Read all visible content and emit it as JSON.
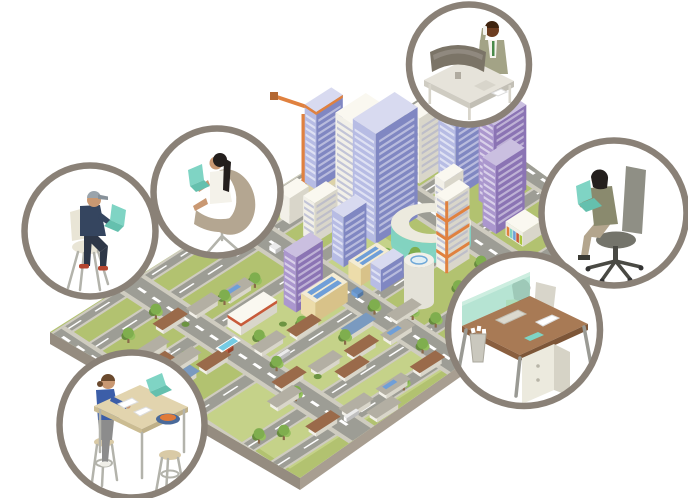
{
  "scene": {
    "description": "Isometric illustration of a city surrounded by six circular vignettes of people working remotely on laptops and at desks",
    "background": "#ffffff"
  },
  "palette": {
    "ring": "#8a8177",
    "slab_top": "#c9c4b8",
    "slab_side": "#958c80",
    "slab_side2": "#a89e91",
    "grass": "#b2c270",
    "grass_light": "#c5d289",
    "road": "#9d9d95",
    "sidewalk": "#cfccc0",
    "tan_ground": "#dcd2a8",
    "pool": "#74cbe4",
    "solar": "#6f9fd8",
    "orange": "#e0813f",
    "red_trim": "#c85a3a",
    "tree1": "#7fae4e",
    "tree3": "#95c05e",
    "trunk": "#8a6a4a",
    "teal": "#7fd4c4",
    "teal_dark": "#65c0ae",
    "metal": "#b3b3ab",
    "skin": "#c99872",
    "skin_dark": "#a06a42",
    "skin_deep": "#6e3d20",
    "hair_black": "#241f1d",
    "hair_brown": "#6b4a2e",
    "hair_dark2": "#3a2420",
    "shirt": "#f6f4ee",
    "tie": "#4a8a4a",
    "olive": "#a3a386",
    "olive_dark": "#8a8a6e",
    "navy": "#35455f",
    "pants_dark": "#2e3748",
    "cap": "#9aa4ac",
    "red_shoe": "#b5452f",
    "blue_top": "#3c5ea8",
    "grey_pants": "#8c8c8c",
    "lime": "#a9c63c",
    "chair_cream": "#e9e5d6",
    "chair_taupe": "#b4a691",
    "chair_grey": "#8f8f85",
    "chair_grey_dark": "#74746b",
    "desk_grey": "#e6e3da",
    "desk_grey_side": "#c6c3b9",
    "monitor": "#7b7467",
    "desk_brown": "#a87a55",
    "desk_brown_dark": "#8a5f3f",
    "glass": "#ace0cd",
    "bin": "#cac8be",
    "bowl": "#4a6a9a",
    "fruit": "#e07b39",
    "paper": "#ffffff",
    "stool": "#d9caa6",
    "table_top": "#e2d4ae",
    "dress": "#f4f2ea"
  },
  "city": {
    "name": "isometric-city",
    "landmarks": [
      "construction-crane",
      "downtown-towers",
      "apartment-towers",
      "solar-roof-offices",
      "helipad-tower",
      "arc-building",
      "shopping-strip",
      "suburban-houses",
      "city-park",
      "street-lamp",
      "house-pool"
    ],
    "colorways": {
      "white": {
        "l": "#f2f0e8",
        "r": "#d9d6ca",
        "t": "#faf8f0",
        "w": "#9aa0c8"
      },
      "blue": {
        "l": "#b7bce4",
        "r": "#8087c2",
        "t": "#d8daf0",
        "w": "#ffffff"
      },
      "purple": {
        "l": "#ab97ce",
        "r": "#8b74b4",
        "t": "#cabfe0",
        "w": "#ffffff"
      },
      "tan": {
        "l": "#ecdcaa",
        "r": "#d8c289",
        "t": "#f4ecd4",
        "w": "#ffffff"
      }
    },
    "roads": {
      "u_roads": [
        [
          0.0,
          0.35
        ],
        [
          1.35,
          1.85
        ],
        [
          3.6,
          4.1
        ],
        [
          6.6,
          7.1
        ],
        [
          9.3,
          9.8
        ],
        [
          10.8,
          11.3
        ]
      ],
      "v_roads": [
        [
          0.0,
          0.3
        ],
        [
          1.9,
          2.4
        ],
        [
          4.6,
          5.1
        ],
        [
          7.35,
          7.85
        ],
        [
          9.5,
          9.95
        ]
      ]
    },
    "patches": [
      [
        5.2,
        0.2,
        4.3,
        1.1
      ],
      [
        2.45,
        4.15,
        4.0,
        2.4
      ],
      [
        0.25,
        6.9,
        4.5,
        2.3
      ],
      [
        8.0,
        0.3,
        1.7,
        1.5
      ],
      [
        0.5,
        9.9,
        4.5,
        1.6
      ]
    ],
    "buildings": [
      {
        "u": 6.5,
        "v": 0.4,
        "du": 0.7,
        "dv": 0.6,
        "h": 78,
        "c": "blue",
        "win": true,
        "construction": true
      },
      {
        "u": 6.4,
        "v": 2.2,
        "du": 0.8,
        "dv": 1.0,
        "h": 95,
        "c": "white",
        "win": true
      },
      {
        "u": 6.2,
        "v": 3.5,
        "du": 1.1,
        "dv": 1.2,
        "h": 110,
        "c": "blue",
        "win": true
      },
      {
        "u": 5.4,
        "v": 2.5,
        "du": 0.6,
        "dv": 0.6,
        "h": 40,
        "c": "white",
        "win": true
      },
      {
        "u": 5.3,
        "v": 4.2,
        "du": 0.6,
        "dv": 0.6,
        "h": 50,
        "c": "blue",
        "win": true
      },
      {
        "u": 5.45,
        "v": 1.2,
        "du": 0.5,
        "dv": 0.5,
        "h": 26,
        "c": "white"
      },
      {
        "u": 8.0,
        "v": 2.7,
        "du": 0.8,
        "dv": 0.7,
        "h": 65,
        "c": "white",
        "win": true
      },
      {
        "u": 8.9,
        "v": 2.0,
        "du": 0.55,
        "dv": 0.8,
        "h": 55,
        "c": "blue",
        "win": true
      },
      {
        "u": 8.2,
        "v": 4.0,
        "du": 1.0,
        "dv": 0.9,
        "h": 95,
        "c": "blue",
        "win": true,
        "poolRoof": true
      },
      {
        "u": 8.45,
        "v": 5.6,
        "du": 0.85,
        "dv": 0.8,
        "h": 85,
        "c": "purple",
        "win": true
      },
      {
        "u": 8.0,
        "v": 6.7,
        "du": 0.75,
        "dv": 0.7,
        "h": 68,
        "c": "purple",
        "win": true
      },
      {
        "u": 7.6,
        "v": 5.0,
        "du": 0.5,
        "dv": 0.5,
        "h": 38,
        "c": "white",
        "win": true
      },
      {
        "u": 3.75,
        "v": 4.75,
        "du": 0.7,
        "dv": 0.65,
        "h": 55,
        "c": "purple",
        "win": true
      },
      {
        "u": 2.55,
        "v": 4.2,
        "du": 0.95,
        "dv": 0.7,
        "h": 12,
        "c": "white",
        "redTrim": true
      },
      {
        "u": 3.8,
        "v": 5.55,
        "du": 0.85,
        "dv": 0.75,
        "h": 20,
        "c": "tan",
        "solar": true
      },
      {
        "u": 5.15,
        "v": 5.35,
        "du": 0.75,
        "dv": 0.65,
        "h": 17,
        "c": "tan",
        "solar": true
      },
      {
        "u": 5.3,
        "v": 6.2,
        "du": 0.6,
        "dv": 0.55,
        "h": 22,
        "c": "blue",
        "win": true
      },
      {
        "u": 6.55,
        "v": 7.15,
        "du": 0.6,
        "dv": 0.55,
        "h": 72,
        "c": "white",
        "orange": true,
        "win": true
      },
      {
        "u": 8.1,
        "v": 7.7,
        "du": 0.5,
        "dv": 0.9,
        "h": 14,
        "c": "white",
        "shops": true
      },
      {
        "u": 4.35,
        "v": 0.7,
        "du": 0.7,
        "dv": 0.6,
        "h": 16,
        "c": "white"
      },
      {
        "u": 5.75,
        "v": 0.5,
        "du": 0.5,
        "dv": 0.45,
        "h": 12,
        "c": "white"
      }
    ],
    "houses": [
      {
        "u": 1.55,
        "v": 2.45,
        "r": "brown"
      },
      {
        "u": 2.3,
        "v": 2.7,
        "r": "grey"
      },
      {
        "u": 3.05,
        "v": 2.95,
        "r": "solar"
      },
      {
        "u": 0.75,
        "v": 3.1,
        "r": "grey"
      },
      {
        "u": 0.5,
        "v": 3.85,
        "r": "brown"
      },
      {
        "u": 0.95,
        "v": 4.35,
        "r": "grey"
      },
      {
        "u": 0.55,
        "v": 5.05,
        "r": "blue"
      },
      {
        "u": 1.3,
        "v": 5.2,
        "r": "brown",
        "pool": true
      },
      {
        "u": 2.4,
        "v": 5.9,
        "r": "grey"
      },
      {
        "u": 3.2,
        "v": 6.15,
        "r": "brown"
      },
      {
        "u": 1.95,
        "v": 7.85,
        "r": "brown"
      },
      {
        "u": 2.75,
        "v": 8.15,
        "r": "grey"
      },
      {
        "u": 3.55,
        "v": 8.45,
        "r": "brown"
      },
      {
        "u": 4.35,
        "v": 8.75,
        "r": "solar"
      },
      {
        "u": 1.5,
        "v": 8.5,
        "r": "grey"
      },
      {
        "u": 3.0,
        "v": 9.05,
        "r": "brown"
      },
      {
        "u": 4.85,
        "v": 8.1,
        "r": "grey"
      },
      {
        "u": 3.95,
        "v": 7.5,
        "r": "blue"
      },
      {
        "u": 1.5,
        "v": 10.5,
        "r": "brown"
      },
      {
        "u": 2.3,
        "v": 10.65,
        "r": "grey"
      },
      {
        "u": 3.2,
        "v": 10.8,
        "r": "solar"
      },
      {
        "u": 4.1,
        "v": 10.8,
        "r": "brown"
      },
      {
        "u": 2.6,
        "v": 11.5,
        "r": "grey"
      }
    ],
    "roof_colors": {
      "brown": "#9a6a4a",
      "grey": "#b3afa3",
      "blue": "#7a9ac0",
      "solar": "#b3afa3",
      "tan": "#cdbb90"
    },
    "trees": [
      [
        8.3,
        0.9
      ],
      [
        8.85,
        1.3
      ],
      [
        8.2,
        1.7
      ],
      [
        9.15,
        0.65
      ],
      [
        8.6,
        0.45
      ],
      [
        5.6,
        0.35
      ],
      [
        4.9,
        1.5
      ],
      [
        0.9,
        2.3
      ],
      [
        1.75,
        2.05
      ],
      [
        0.45,
        3.35
      ],
      [
        1.2,
        4.7
      ],
      [
        0.7,
        5.6
      ],
      [
        2.95,
        3.25
      ],
      [
        3.7,
        3.35
      ],
      [
        2.6,
        5.75
      ],
      [
        3.45,
        6.3
      ],
      [
        4.35,
        4.35
      ],
      [
        5.95,
        5.75
      ],
      [
        6.35,
        6.45
      ],
      [
        4.75,
        7.5
      ],
      [
        3.75,
        7.95
      ],
      [
        2.3,
        7.25
      ],
      [
        5.15,
        8.7
      ],
      [
        6.25,
        8.9
      ],
      [
        1.95,
        8.95
      ],
      [
        7.05,
        8.5
      ],
      [
        7.75,
        2.3
      ],
      [
        6.2,
        1.6
      ],
      [
        1.0,
        10.2
      ],
      [
        3.6,
        11.3
      ],
      [
        4.6,
        10.3
      ],
      [
        5.3,
        9.6
      ],
      [
        0.6,
        9.7
      ]
    ],
    "bushes": [
      [
        2.0,
        3.1
      ],
      [
        0.8,
        4.0
      ],
      [
        3.3,
        5.6
      ],
      [
        4.1,
        6.2
      ],
      [
        2.7,
        8.6
      ],
      [
        5.5,
        7.9
      ],
      [
        8.0,
        1.2
      ],
      [
        6.9,
        8.9
      ]
    ],
    "cars": [
      {
        "u": 0.9,
        "v": 3.72,
        "du": 0.32,
        "dv": 0.15,
        "c": "#ffffff"
      },
      {
        "u": 3.2,
        "v": 3.95,
        "du": 0.32,
        "dv": 0.15,
        "c": "#e0813f"
      },
      {
        "u": 4.66,
        "v": 2.2,
        "du": 0.15,
        "dv": 0.32,
        "c": "#ffffff"
      },
      {
        "u": 4.85,
        "v": 6.1,
        "du": 0.15,
        "dv": 0.32,
        "c": "#6f9fd8"
      },
      {
        "u": 2.5,
        "v": 6.78,
        "du": 0.32,
        "dv": 0.15,
        "c": "#ffffff"
      },
      {
        "u": 5.9,
        "v": 6.95,
        "du": 0.32,
        "dv": 0.15,
        "c": "#b0b0a8"
      },
      {
        "u": 2.0,
        "v": 5.0,
        "du": 0.15,
        "dv": 0.3,
        "c": "#c85a3a"
      },
      {
        "u": 9.6,
        "v": 4.3,
        "du": 0.15,
        "dv": 0.32,
        "c": "#ffffff"
      },
      {
        "u": 2.2,
        "v": 10.95,
        "du": 0.32,
        "dv": 0.15,
        "c": "#ffffff"
      }
    ],
    "shop_stripes": [
      "#e0813f",
      "#7fd4c4",
      "#6f9fd8",
      "#c85a3a",
      "#a9c63c"
    ]
  },
  "vignettes": [
    {
      "id": "executive-phone-desk",
      "description": "Businessperson standing at an office desk with a curved monitor, talking on the phone"
    },
    {
      "id": "freelancer-egg-chair",
      "description": "Woman with long dark hair working on a teal laptop in an egg chair"
    },
    {
      "id": "remote-worker-cap",
      "description": "Man in a cap working on a teal laptop while seated on a chair"
    },
    {
      "id": "cafe-high-table",
      "description": "Person in a blue top working at a tall cafe table with a laptop, papers and a fruit bowl"
    },
    {
      "id": "home-office-chair",
      "description": "Woman working on a teal laptop in a grey swivel office chair"
    },
    {
      "id": "reception-desk",
      "description": "Woman in a green top at a wooden desk with a glass screen, keyboard, drawer unit and shredder bin"
    }
  ]
}
